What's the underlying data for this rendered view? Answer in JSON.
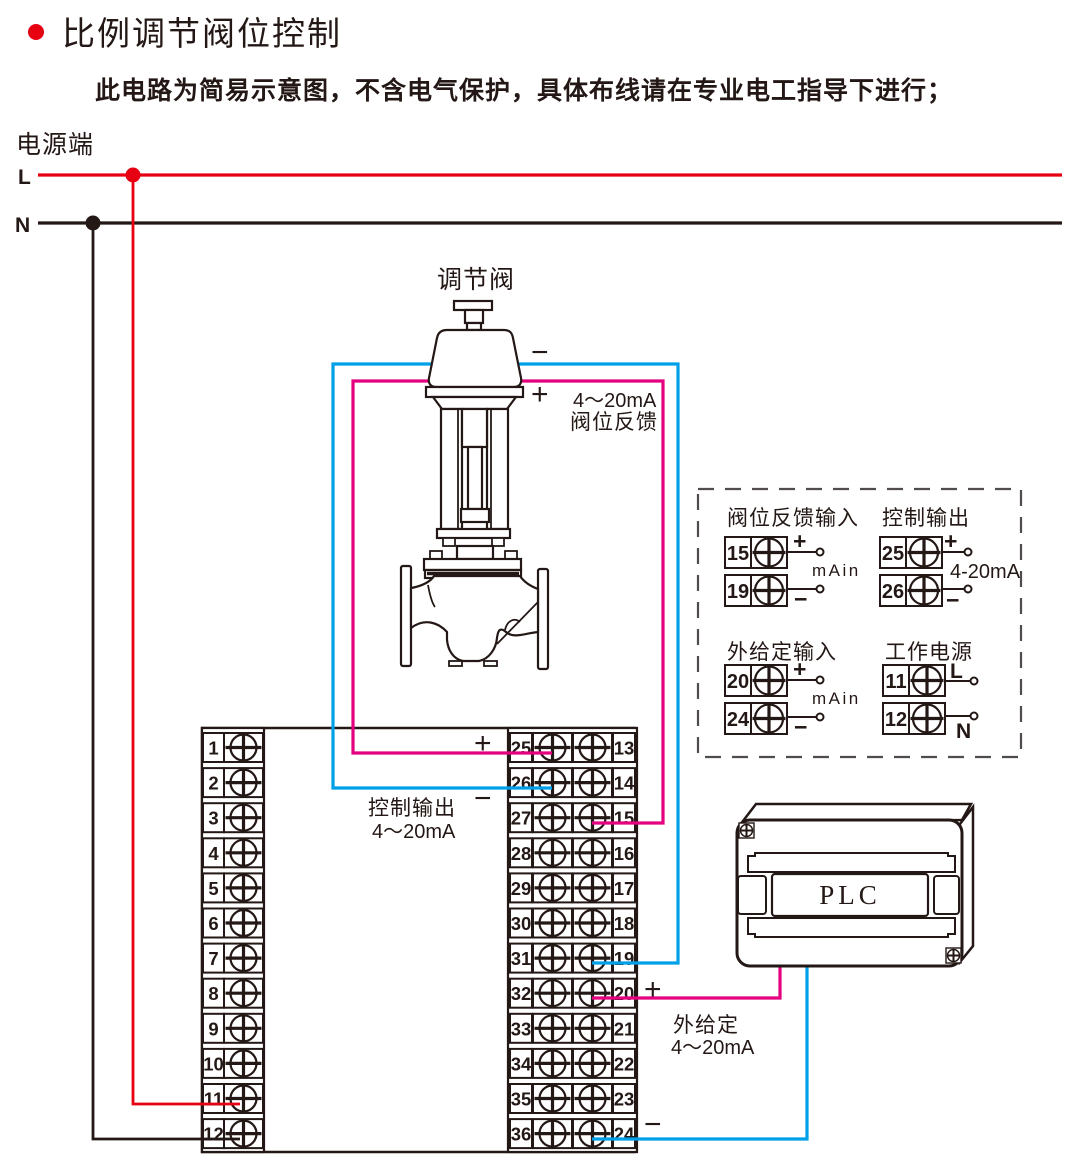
{
  "title": "比例调节阀位控制",
  "subtitle": "此电路为简易示意图，不含电气保护，具体布线请在专业电工指导下进行；",
  "colors": {
    "red": "#e60012",
    "black": "#231815",
    "magenta": "#e4007f",
    "cyan": "#00a0e9",
    "dash_gray": "#4f4c4b"
  },
  "power": {
    "section_label": "电源端",
    "live": "L",
    "neutral": "N"
  },
  "valve": {
    "title": "调节阀",
    "minus": "−",
    "plus": "+",
    "feedback_note_line1": "4～20mA",
    "feedback_note_line2": "阀位反馈"
  },
  "control_output_note": {
    "plus": "+",
    "minus": "−",
    "line1": "控制输出",
    "line2": "4～20mA"
  },
  "external_setpoint_note": {
    "plus": "+",
    "minus": "−",
    "line1": "外给定",
    "line2": "4～20mA"
  },
  "left_strip": {
    "terminals": [
      "1",
      "2",
      "3",
      "4",
      "5",
      "6",
      "7",
      "8",
      "9",
      "10",
      "11",
      "12"
    ]
  },
  "center_strip": {
    "left_terminals": [
      "25",
      "26",
      "27",
      "28",
      "29",
      "30",
      "31",
      "32",
      "33",
      "34",
      "35",
      "36"
    ],
    "right_terminals": [
      "13",
      "14",
      "15",
      "16",
      "17",
      "18",
      "19",
      "20",
      "21",
      "22",
      "23",
      "24"
    ]
  },
  "detail_box": {
    "groups": [
      {
        "title": "阀位反馈输入",
        "terminal_top": "15",
        "terminal_bottom": "19",
        "plus": "+",
        "minus": "−",
        "mid_label": "mAin"
      },
      {
        "title": "控制输出",
        "terminal_top": "25",
        "terminal_bottom": "26",
        "plus": "+",
        "minus": "−",
        "mid_label": "4-20mA"
      },
      {
        "title": "外给定输入",
        "terminal_top": "20",
        "terminal_bottom": "24",
        "plus": "+",
        "minus": "−",
        "mid_label": "mAin"
      },
      {
        "title": "工作电源",
        "terminal_top": "11",
        "terminal_bottom": "12",
        "top_label": "L",
        "bottom_label": "N"
      }
    ]
  },
  "plc": {
    "label": "PLC"
  }
}
